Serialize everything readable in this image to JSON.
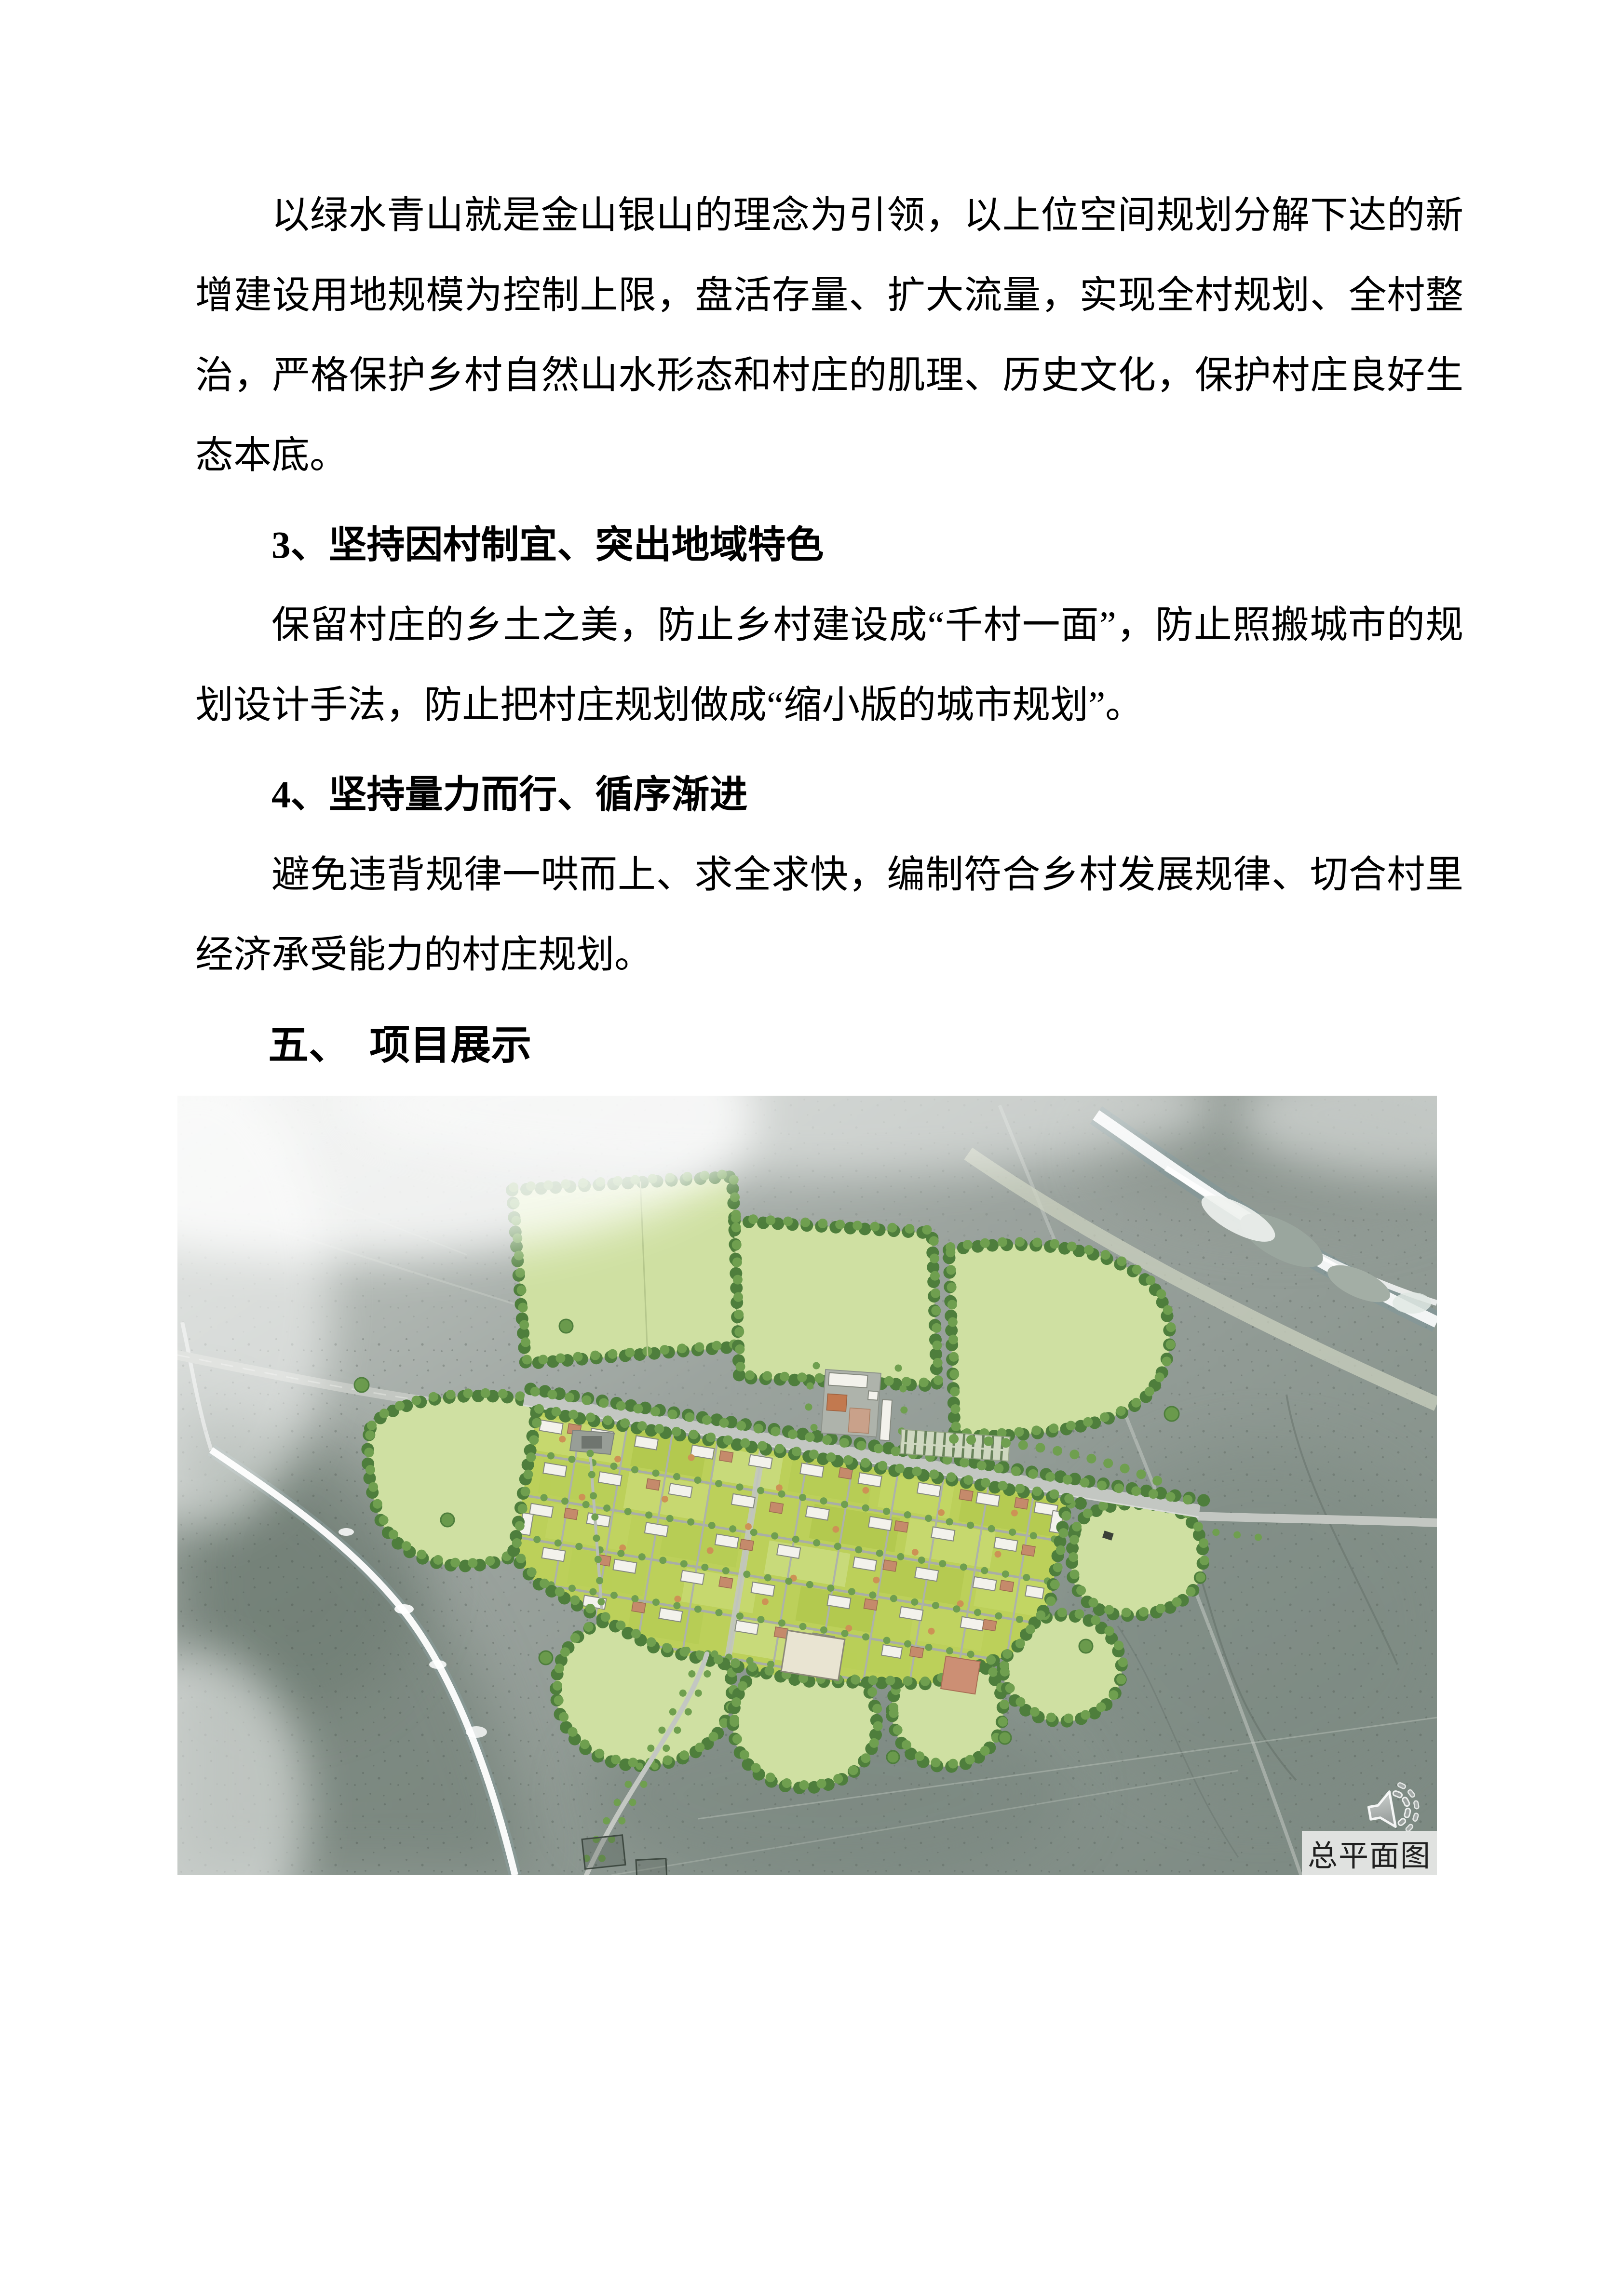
{
  "document": {
    "paragraphs": [
      {
        "role": "body",
        "text": "以绿水青山就是金山银山的理念为引领，以上位空间规划分解下达的新增建设用地规模为控制上限，盘活存量、扩大流量，实现全村规划、全村整治，严格保护乡村自然山水形态和村庄的肌理、历史文化，保护村庄良好生态本底。"
      },
      {
        "role": "heading",
        "text": "3、坚持因村制宜、突出地域特色"
      },
      {
        "role": "body",
        "text": "保留村庄的乡土之美，防止乡村建设成“千村一面”，防止照搬城市的规划设计手法，防止把村庄规划做成“缩小版的城市规划”。"
      },
      {
        "role": "heading",
        "text": "4、坚持量力而行、循序渐进"
      },
      {
        "role": "body",
        "text": "避免违背规律一哄而上、求全求快，编制符合乡村发展规律、切合村里经济承受能力的村庄规划。"
      },
      {
        "role": "section-heading",
        "text": "五、　项目展示"
      }
    ],
    "figure": {
      "caption": "总平面图",
      "audio_icon": "speaker-icon"
    }
  },
  "colors": {
    "page_bg": "#ffffff",
    "text": "#000000",
    "terrain_gray": "#98a19b",
    "terrain_dark": "#6d7b72",
    "field_green": "#cfe0a2",
    "plot_green": "#bcd05a",
    "tree_dark": "#4e7e3c",
    "tree_mid": "#6f9f4f",
    "house_white": "#f3f2ec",
    "roof_terracotta": "#c58a6b",
    "roof_orange": "#c2794f",
    "road_gray": "#c3c7c2",
    "river_white": "#ffffff",
    "river_shadow": "#8ba0a0",
    "caption_bg": "#e7e8e6",
    "caption_text": "#202020"
  }
}
